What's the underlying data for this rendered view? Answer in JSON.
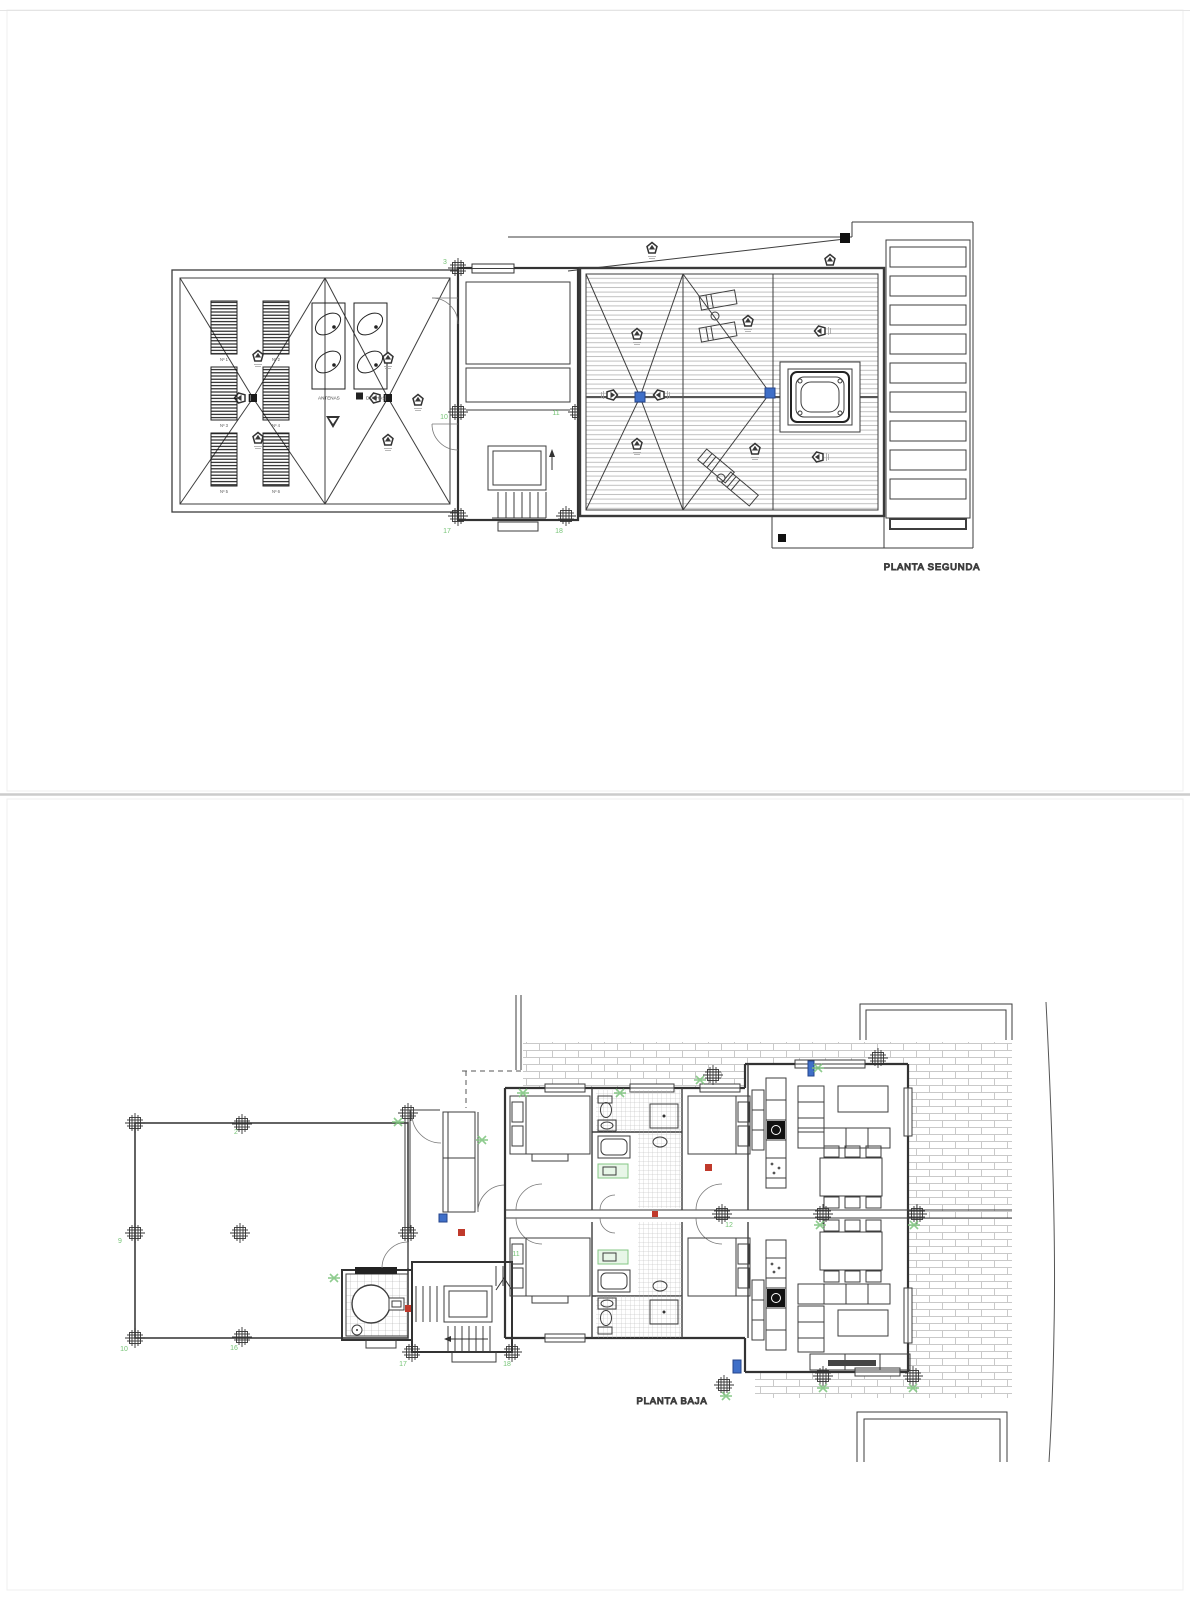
{
  "page": {
    "background": "#ffffff",
    "divider_color": "#cccccc",
    "sheet_border_color": "#efefef"
  },
  "colors": {
    "line": "#3d3d3d",
    "wall": "#333333",
    "deck_boards": "#bfbfbf",
    "brick": "#c9c9c9",
    "tile": "#b0b0b0",
    "grid_green": "#76c476",
    "fixture_green_fill": "#e8f6e8",
    "marker_blue": "#3f6fc8",
    "marker_red": "#c0392b",
    "node_black": "#1a1a1a",
    "caption_gray": "#4a4a4a"
  },
  "plan_segunda": {
    "title": "PLANTA SEGUNDA",
    "labels": {
      "antenas": "ANTENAS",
      "duchas": "DUCHAS"
    },
    "panel_labels": [
      "Nº 1",
      "Nº 2",
      "Nº 3",
      "Nº 4",
      "Nº 5",
      "Nº 6"
    ],
    "grid_numbers": [
      {
        "n": "3",
        "x": 445,
        "y": 264
      },
      {
        "n": "10",
        "x": 444,
        "y": 419
      },
      {
        "n": "11",
        "x": 556,
        "y": 415
      },
      {
        "n": "17",
        "x": 447,
        "y": 533
      },
      {
        "n": "18",
        "x": 559,
        "y": 533
      }
    ]
  },
  "plan_baja": {
    "title": "PLANTA BAJA",
    "grid_numbers": [
      {
        "n": "2",
        "x": 236,
        "y": 1134
      },
      {
        "n": "9",
        "x": 120,
        "y": 1243
      },
      {
        "n": "10",
        "x": 124,
        "y": 1351
      },
      {
        "n": "16",
        "x": 234,
        "y": 1350
      },
      {
        "n": "11",
        "x": 516,
        "y": 1256
      },
      {
        "n": "12",
        "x": 729,
        "y": 1227
      },
      {
        "n": "17",
        "x": 403,
        "y": 1366
      },
      {
        "n": "18",
        "x": 507,
        "y": 1366
      }
    ]
  }
}
